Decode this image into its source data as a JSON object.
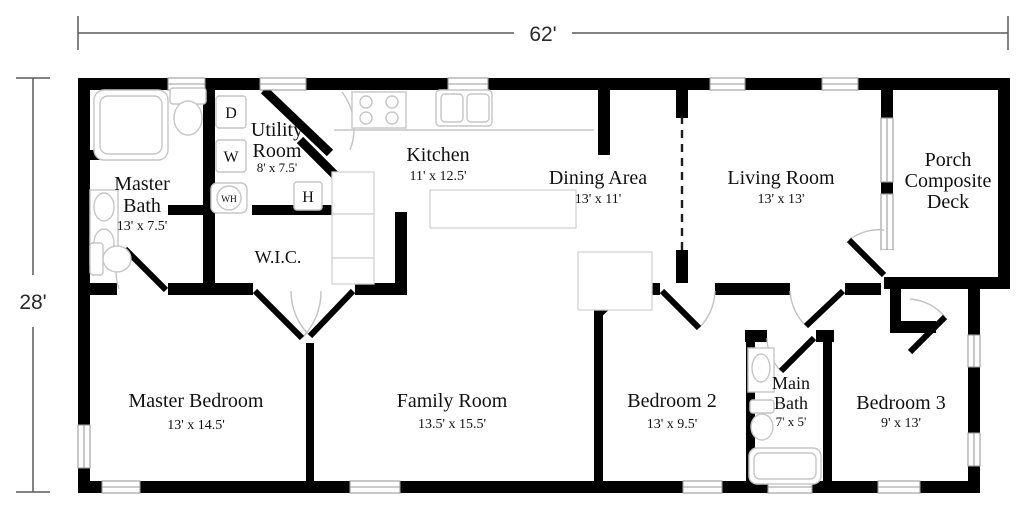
{
  "dims": {
    "width": "62'",
    "height": "28'"
  },
  "rooms": {
    "master_bath": {
      "line1": "Master",
      "line2": "Bath",
      "size": "13' x 7.5'"
    },
    "utility": {
      "line1": "Utility",
      "line2": "Room",
      "size": "8' x 7.5'"
    },
    "kitchen": {
      "name": "Kitchen",
      "size": "11' x 12.5'"
    },
    "dining": {
      "name": "Dining Area",
      "size": "13' x 11'"
    },
    "living": {
      "name": "Living Room",
      "size": "13' x 13'"
    },
    "porch": {
      "line1": "Porch",
      "line2": "Composite",
      "line3": "Deck"
    },
    "wic": {
      "name": "W.I.C."
    },
    "master_bedroom": {
      "name": "Master Bedroom",
      "size": "13' x 14.5'"
    },
    "family": {
      "name": "Family Room",
      "size": "13.5' x 15.5'"
    },
    "bedroom2": {
      "name": "Bedroom 2",
      "size": "13' x 9.5'"
    },
    "main_bath": {
      "line1": "Main",
      "line2": "Bath",
      "size": "7' x 5'"
    },
    "bedroom3": {
      "name": "Bedroom 3",
      "size": "9' x 13'"
    }
  },
  "appliances": {
    "dryer": "D",
    "washer": "W",
    "water_heater": "WH",
    "furnace": "H"
  },
  "colors": {
    "wall": "#000000",
    "fixture_outline": "#c6c6c6",
    "dimension_line": "#5a5a5a"
  }
}
